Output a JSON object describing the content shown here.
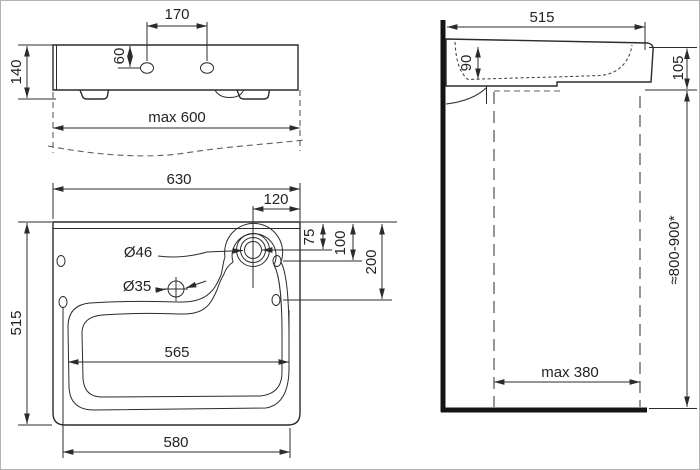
{
  "views": {
    "front": {
      "label_170": "170",
      "label_60": "60",
      "label_140": "140",
      "label_max600": "max 600"
    },
    "plan": {
      "label_630": "630",
      "label_120": "120",
      "label_75": "75",
      "label_100": "100",
      "label_200": "200",
      "label_d46": "Ø46",
      "label_d35": "Ø35",
      "label_565": "565",
      "label_515": "515",
      "label_580": "580"
    },
    "side": {
      "label_515": "515",
      "label_90": "90",
      "label_105": "105",
      "label_mount_height": "≈800-900*",
      "label_max380": "max 380"
    }
  },
  "colors": {
    "line": "#2b2b2b",
    "thick_wall": "#141414",
    "dashed_hidden": "#8a8a8a",
    "background": "#ffffff",
    "border": "#b3b3b3"
  }
}
